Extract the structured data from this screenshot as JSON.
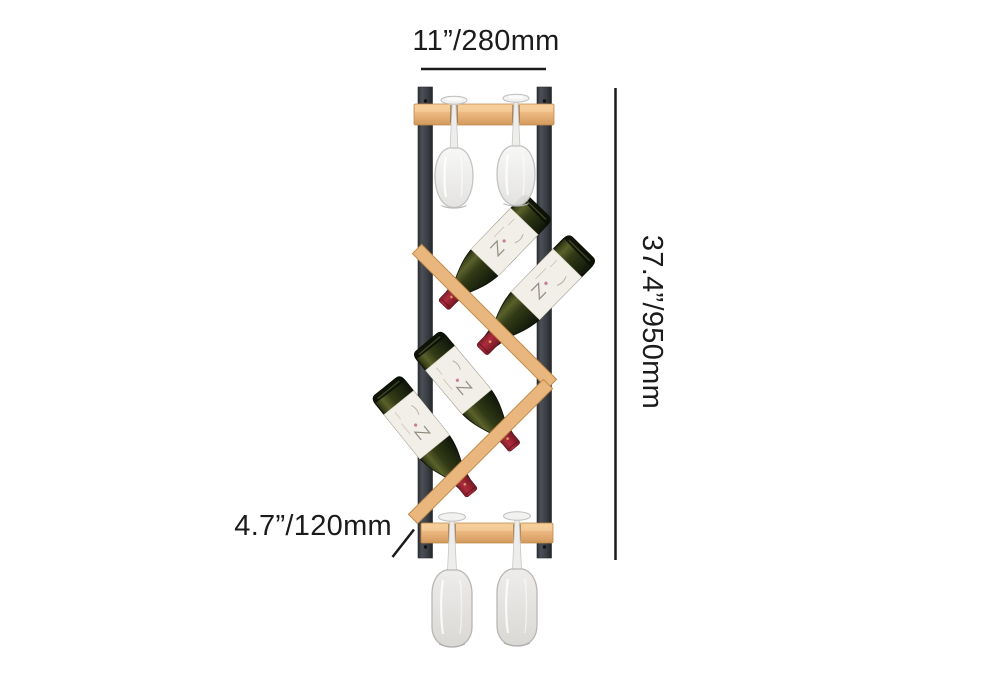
{
  "page": {
    "background": "#ffffff",
    "description": "Product dimension diagram of a wall-mounted wine rack holding 4 bottles and 4 hanging stem glasses"
  },
  "annotations": {
    "width_label": "11”/280mm",
    "height_label": "37.4”/950mm",
    "depth_label": "4.7”/120mm"
  },
  "product": {
    "type": "wall-mounted wine rack",
    "bottle_count": 4,
    "glass_count": 4,
    "structure": "two vertical metal rails, wood top and bottom stemware shelves, zigzag diagonal wood slats holding bottles"
  },
  "colors": {
    "background": "#ffffff",
    "dimension": "#1b1b1b",
    "metal": "#3e4248",
    "metal_dark": "#26292d",
    "wood": "#e9b77d",
    "wood_light": "#f6cf9c",
    "wood_dark": "#c08a4c",
    "bottle_glass": "#2a3112",
    "bottle_label": "#f1efe8",
    "cap_red": "#9c2435",
    "glassware": "#e8e6e4"
  }
}
